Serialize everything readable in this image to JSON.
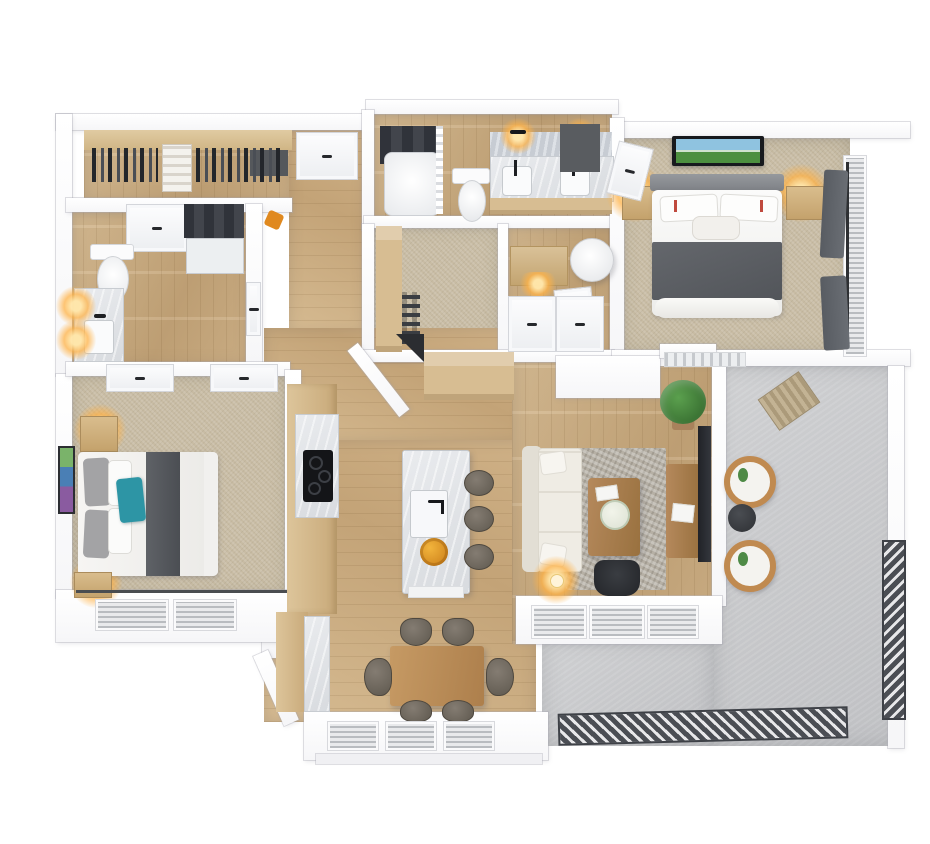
{
  "scene": {
    "title": "3D apartment floor plan render",
    "palette": {
      "wall": "#ffffff",
      "wood_floor": "#cdb088",
      "carpet": "#c8bca4",
      "concrete": "#c7c8ca",
      "marble": "#e3e5e8",
      "cabinet_wood": "#d7bd92",
      "furniture_wood": "#a87c52",
      "dark_tile": "#3b3e44",
      "blanket_gray": "#5b5e63",
      "accent_teal": "#2d95a5",
      "sofa_cream": "#efece4",
      "rug_gray": "#b6b0a5",
      "plant_green": "#3f7d3a",
      "railing_dark": "#4b4e54",
      "lamp_glow": "#ffb054",
      "fruit_orange": "#e0891f"
    },
    "rooms": [
      {
        "name": "walk-in-closet-top-left",
        "floor": "wood",
        "items": [
          "hanging-clothes",
          "linen-shelf"
        ]
      },
      {
        "name": "bathroom-2",
        "floor": "wood",
        "items": [
          "toilet",
          "marble-vanity",
          "wall-sconces",
          "dark-tile-shower",
          "double-door"
        ]
      },
      {
        "name": "bedroom-2",
        "floor": "carpet",
        "items": [
          "double-bed",
          "teal-accent-pillow",
          "nightstands-with-lamps",
          "wall-art",
          "closet-doors",
          "blind-windows"
        ]
      },
      {
        "name": "entry-hall",
        "floor": "wood",
        "items": [
          "entry-door",
          "dark-nook",
          "coat"
        ]
      },
      {
        "name": "master-bathroom",
        "floor": "wood",
        "items": [
          "tub-shower-dark-tile",
          "toilet",
          "double-vanity",
          "two-sconce-lights"
        ]
      },
      {
        "name": "master-closet",
        "floor": "carpet",
        "items": [
          "shoe-shelves",
          "door"
        ]
      },
      {
        "name": "laundry-closet",
        "floor": "wood",
        "items": [
          "cabinet",
          "round-basket",
          "double-doors"
        ]
      },
      {
        "name": "master-bedroom",
        "floor": "carpet",
        "items": [
          "bed-gray-blanket",
          "tv-art-above-headboard",
          "nightstands-with-lamps",
          "dark-curtain-windows",
          "balcony-door"
        ]
      },
      {
        "name": "kitchen",
        "floor": "wood",
        "items": [
          "counter-run",
          "black-cooktop",
          "pantry-shelves",
          "marble-island",
          "island-sink-faucet",
          "fruit-bowl",
          "three-bar-stools"
        ]
      },
      {
        "name": "dining-area",
        "floor": "wood",
        "items": [
          "wood-table",
          "six-chairs",
          "blind-windows"
        ]
      },
      {
        "name": "living-room",
        "floor": "wood",
        "items": [
          "cream-sectional-sofa",
          "textured-rug",
          "coffee-table-flowers",
          "media-console",
          "wall-mounted-tv",
          "potted-plant",
          "desk-chair",
          "glowing-floor-lamp",
          "blind-windows"
        ]
      },
      {
        "name": "balcony",
        "floor": "concrete",
        "items": [
          "two-round-chairs",
          "dark-side-table",
          "doormat",
          "metal-slat-railing",
          "parapet-wall"
        ]
      }
    ]
  }
}
